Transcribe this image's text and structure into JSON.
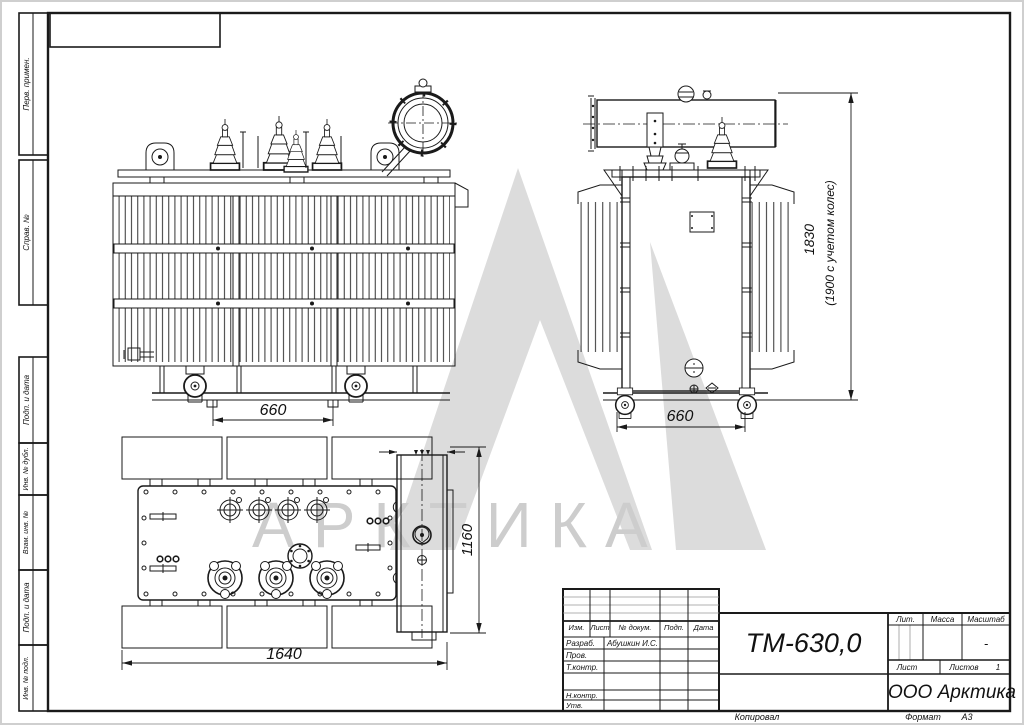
{
  "watermark": {
    "text": "АРКТИКА"
  },
  "strips": [
    {
      "label": "Перв. примен."
    },
    {
      "label": "Справ. №"
    },
    {
      "label": "Подп. и дата"
    },
    {
      "label": "Инв. № дубл."
    },
    {
      "label": "Взам. инв. №"
    },
    {
      "label": "Подп. и дата"
    },
    {
      "label": "Инв. № подл."
    }
  ],
  "stamp": {
    "designation": "ТМ-630,0",
    "company": "ООО Арктика",
    "cols": {
      "izm": "Изм.",
      "list": "Лист",
      "doc": "№ докум.",
      "podp": "Подп.",
      "data": "Дата"
    },
    "rows": {
      "razrab_label": "Разраб.",
      "razrab_name": "Абушкин И.С.",
      "prov_label": "Пров.",
      "tkontr_label": "Т.контр.",
      "nkontr_label": "Н.контр.",
      "utv_label": "Утв."
    },
    "lit_label": "Лит.",
    "massa_label": "Масса",
    "masshtab_label": "Масштаб",
    "masshtab_value": "-",
    "list_label": "Лист",
    "listov_label": "Листов",
    "listov_value": "1"
  },
  "footer": {
    "kopiroval": "Копировал",
    "format_label": "Формат",
    "format_value": "А3"
  },
  "dimensions": {
    "front_wheelbase": "660",
    "side_wheelbase": "660",
    "top_length": "1640",
    "top_width": "1160",
    "height": "1830",
    "height_note": "(1900 с учетом колес)"
  },
  "colors": {
    "line": "#1a1a1a",
    "watermark": "#dcdcdc"
  }
}
